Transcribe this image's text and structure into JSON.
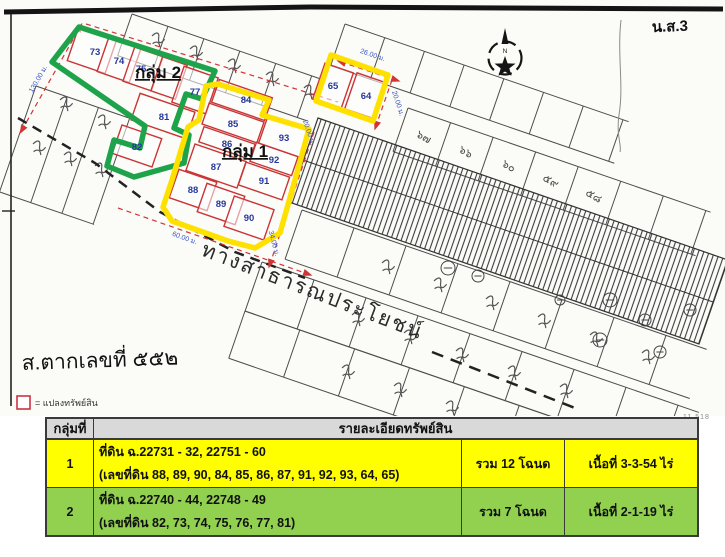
{
  "legend": {
    "label": "= แปลงทรัพย์สิน"
  },
  "map": {
    "group1_label": "กลุ่ม 1",
    "group2_label": "กลุ่ม 2",
    "compass_letter": "N",
    "corner_note": "น.ส.3",
    "doc_note": "ส.ตากเลขที่ ๕๕๒",
    "road_label": "ทางสาธารณประโยชน์",
    "scan_code": "11.518",
    "plots_group2": [
      "73",
      "74",
      "75",
      "77",
      "81",
      "82"
    ],
    "plots_group1": [
      "84",
      "85",
      "86",
      "87",
      "88",
      "89",
      "90",
      "91",
      "92",
      "93"
    ],
    "plots_group1_box": [
      "65",
      "64"
    ],
    "bg_plot_numbers": [
      "๖๗",
      "๖๖",
      "๖๐",
      "๕๙",
      "๕๘"
    ],
    "dimensions": [
      "130.00 ม.",
      "26.00 ม.",
      "20.00 ม.",
      "20.00 ม.",
      "34.00 ม.",
      "60.00 ม."
    ]
  },
  "colors": {
    "group1_outline": "#ffe100",
    "group2_outline": "#1ea34a",
    "plot_border": "#c93535",
    "plot_number": "#27379b",
    "dimension_text": "#3a56c4",
    "row1_bg": "#ffff00",
    "row2_bg": "#92d050",
    "header_bg": "#d9d9d9"
  },
  "table": {
    "headers": {
      "col1": "กลุ่มที่",
      "col2": "รายละเอียดทรัพย์สิน"
    },
    "rows": [
      {
        "group": "1",
        "line1": "ที่ดิน ฉ.22731 - 32, 22751 - 60",
        "line2": "(เลขที่ดิน 88, 89, 90, 84, 85, 86, 87, 91, 92, 93, 64, 65)",
        "total": "รวม 12 โฉนด",
        "area": "เนื้อที่ 3-3-54 ไร่",
        "color": "#ffff00"
      },
      {
        "group": "2",
        "line1": "ที่ดิน ฉ.22740 - 44, 22748 - 49",
        "line2": "(เลขที่ดิน 82, 73, 74, 75, 76, 77, 81)",
        "total": "รวม 7 โฉนด",
        "area": "เนื้อที่ 2-1-19 ไร่",
        "color": "#92d050"
      }
    ]
  }
}
